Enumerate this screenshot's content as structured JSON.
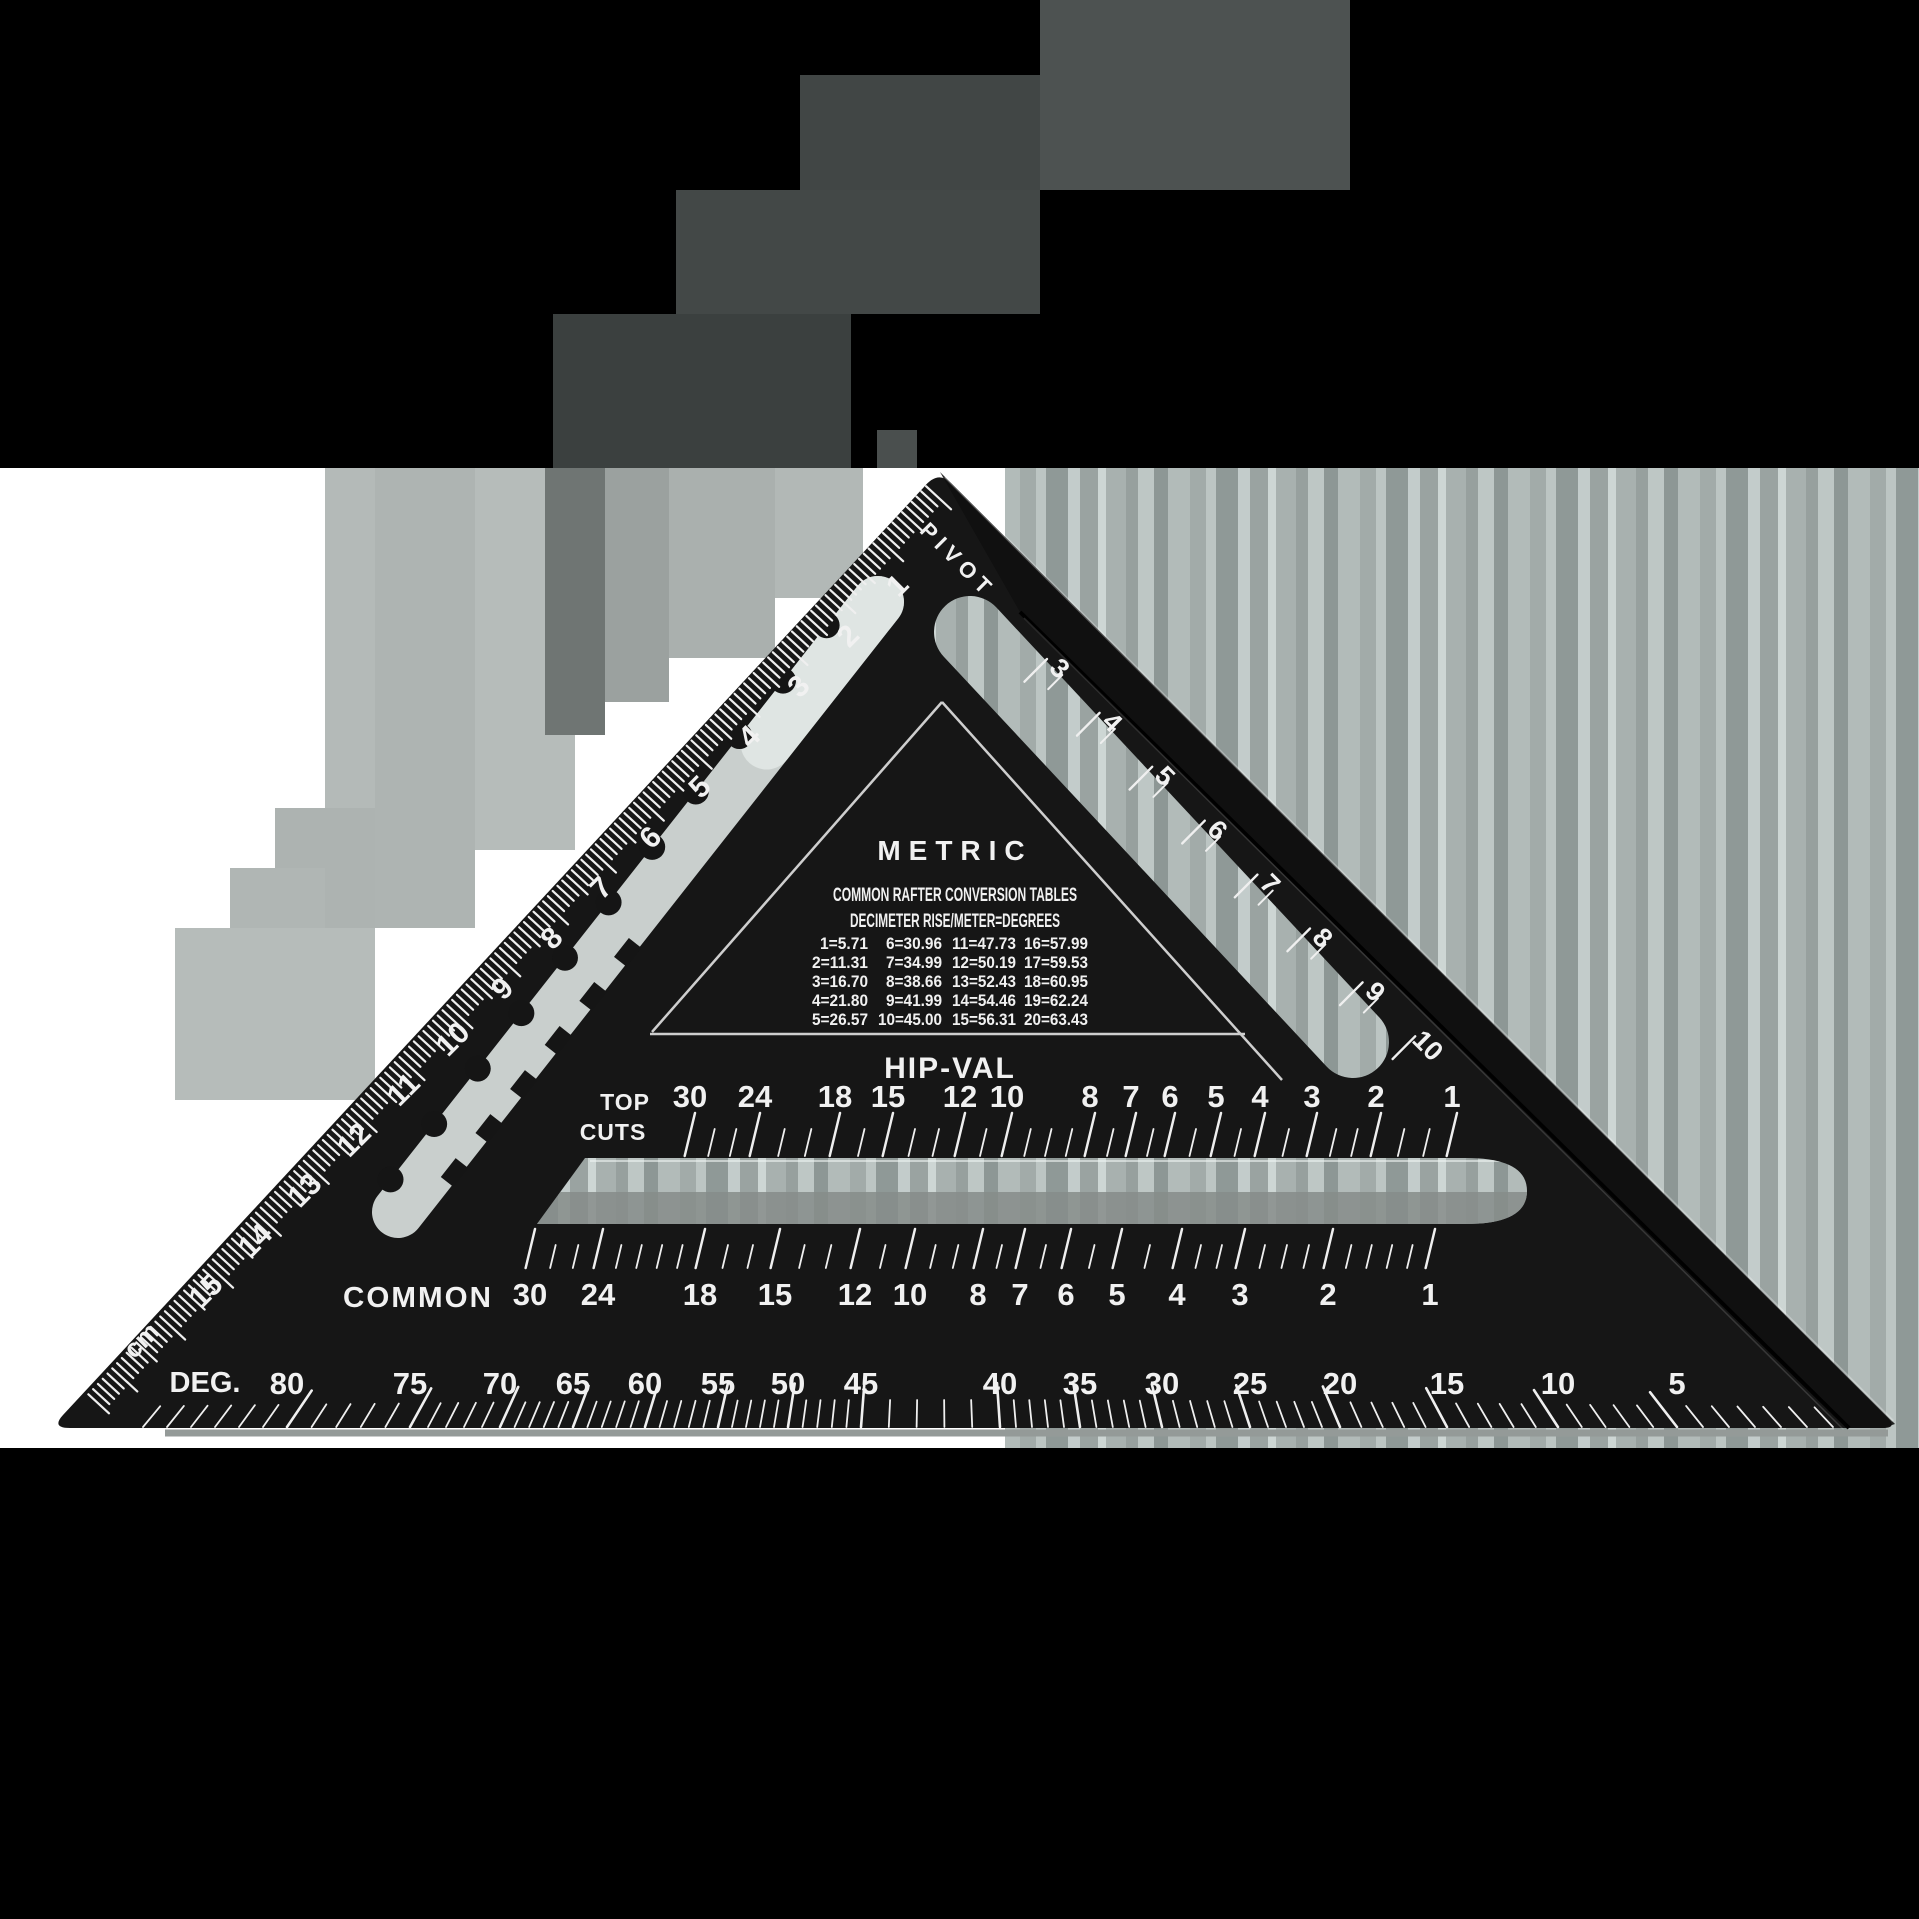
{
  "pivot_label": "PIVOT",
  "left_ruler": {
    "unit_label": "cm",
    "values": [
      "1",
      "2",
      "3",
      "4",
      "5",
      "6",
      "7",
      "8",
      "9",
      "10",
      "11",
      "12",
      "13",
      "14",
      "15"
    ]
  },
  "right_ruler": {
    "values": [
      "3",
      "4",
      "5",
      "6",
      "7",
      "8",
      "9",
      "10"
    ]
  },
  "metric_panel": {
    "title": "METRIC",
    "subtitle1": "COMMON RAFTER CONVERSION TABLES",
    "subtitle2": "DECIMETER RISE/METER=DEGREES",
    "table_rows": [
      [
        "1=5.71",
        "6=30.96",
        "11=47.73",
        "16=57.99"
      ],
      [
        "2=11.31",
        "7=34.99",
        "12=50.19",
        "17=59.53"
      ],
      [
        "3=16.70",
        "8=38.66",
        "13=52.43",
        "18=60.95"
      ],
      [
        "4=21.80",
        "9=41.99",
        "14=54.46",
        "19=62.24"
      ],
      [
        "5=26.57",
        "10=45.00",
        "15=56.31",
        "20=63.43"
      ]
    ]
  },
  "hip_val_label": "HIP-VAL",
  "top_cuts": {
    "label_line1": "TOP",
    "label_line2": "CUTS",
    "values": [
      "30",
      "24",
      "18",
      "15",
      "12",
      "10",
      "8",
      "7",
      "6",
      "5",
      "4",
      "3",
      "2",
      "1"
    ]
  },
  "common": {
    "label": "COMMON",
    "values": [
      "30",
      "24",
      "18",
      "15",
      "12",
      "10",
      "8",
      "7",
      "6",
      "5",
      "4",
      "3",
      "2",
      "1"
    ]
  },
  "degrees": {
    "label": "DEG.",
    "values": [
      "80",
      "75",
      "70",
      "65",
      "60",
      "55",
      "50",
      "45",
      "40",
      "35",
      "30",
      "25",
      "20",
      "15",
      "10",
      "5"
    ]
  },
  "colors": {
    "canvas": "#000000",
    "backdrop": "#ffffff",
    "body": "#151515",
    "fence": "#0f0f0f",
    "marking": "#f1f1f1",
    "slot_left": "#c9cfcd",
    "slot_shadow": "#868c8a",
    "bevel": "#949a98"
  }
}
